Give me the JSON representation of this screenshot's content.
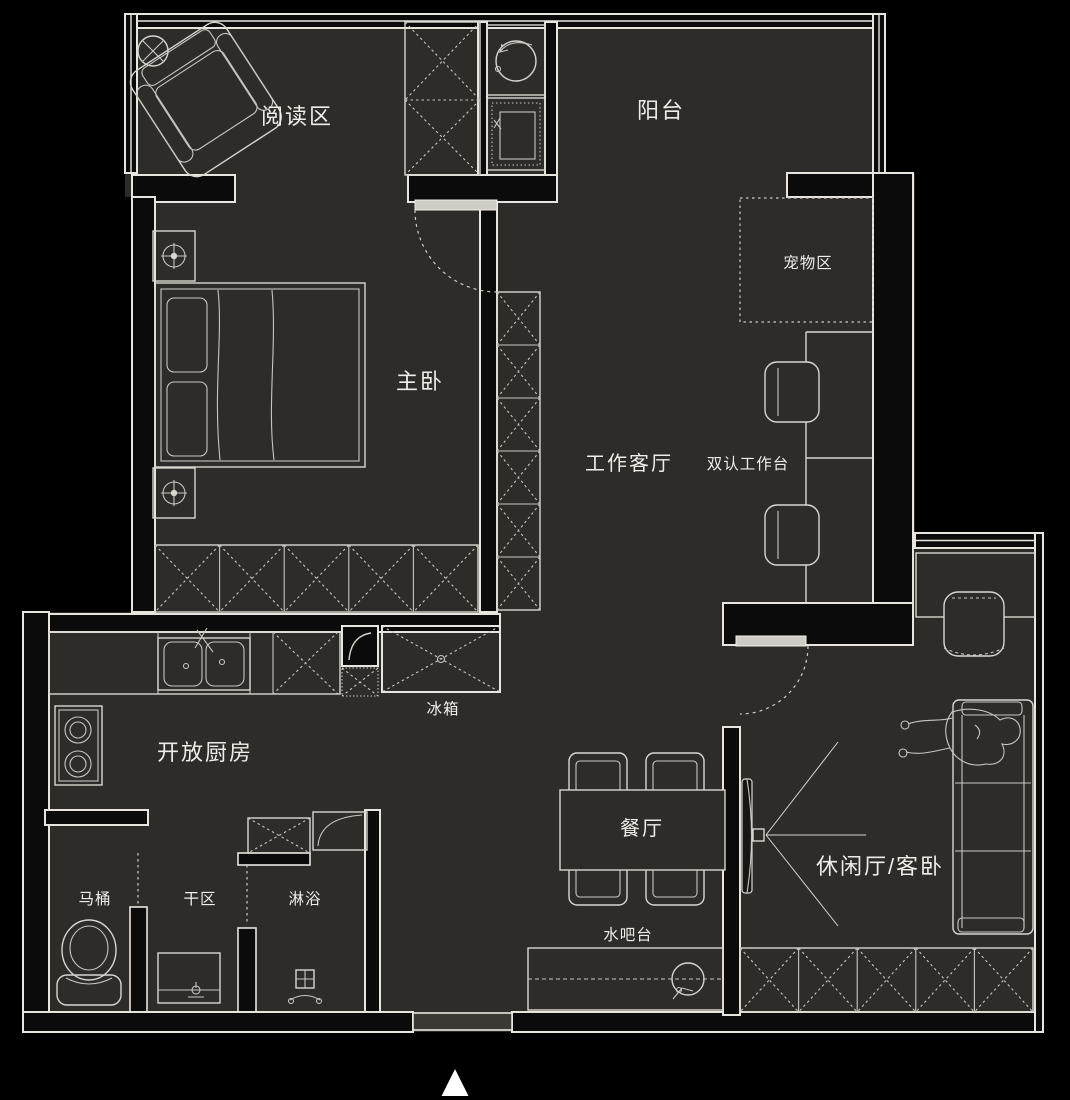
{
  "title": "apartment-floor-plan",
  "colors": {
    "background": "#000000",
    "floor": "#2e2c29",
    "wall": "#0b0b0b",
    "line": "#e8e5de",
    "text": "#f0ede7"
  },
  "labels": {
    "reading_area": "阅读区",
    "balcony": "阳台",
    "pet_area": "宠物区",
    "master_bedroom": "主卧",
    "work_living_room": "工作客厅",
    "dual_workstation": "双认工作台",
    "fridge": "冰箱",
    "open_kitchen": "开放厨房",
    "dining_room": "餐厅",
    "water_bar": "水吧台",
    "leisure_guest_room": "休闲厅/客卧",
    "toilet": "马桶",
    "dry_area": "干区",
    "shower": "淋浴"
  },
  "icons": {
    "entrance_arrow": "▲"
  }
}
